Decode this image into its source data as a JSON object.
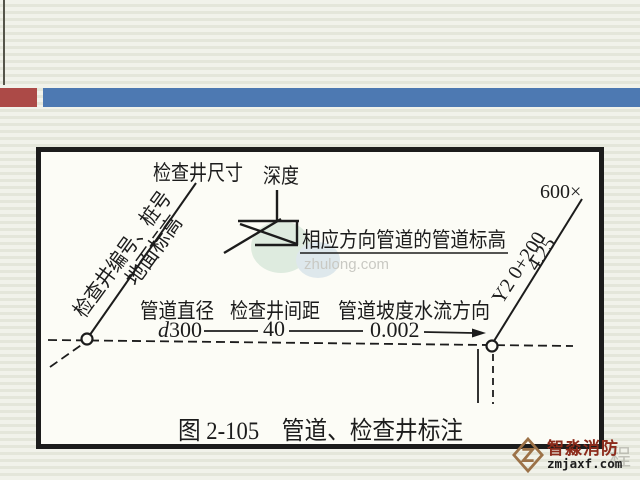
{
  "colors": {
    "accent_red": "#ac4a47",
    "accent_blue": "#4d79b2",
    "slide_bg_light": "#f1f2ea",
    "slide_bg_dark": "#e4e6da",
    "paper": "#fcfcf6",
    "ink": "#1c1c1c",
    "brand_red": "#8c2b1c",
    "logo_tan": "#9c7248",
    "ghost_gray": "#c9c9c3"
  },
  "figure": {
    "top_labels": {
      "well_size": "检查井尺寸",
      "depth": "深度"
    },
    "rotated_left": {
      "well_number": "检查井编号、桩号",
      "ground_elevation": "地面标高"
    },
    "pipe_elevation_label": "相应方向管道的管道标高",
    "column_labels": {
      "pipe_diameter": "管道直径",
      "well_spacing": "检查井间距",
      "slope_flow": "管道坡度水流方向"
    },
    "values": {
      "diameter_prefix": "d",
      "diameter_number": "300",
      "spacing": "40",
      "slope": "0.002"
    },
    "right_leader": {
      "station_end": "600×",
      "well_id_station": "Y2  0+200",
      "invert_elevation": "4.25"
    },
    "caption": "图 2-105　管道、检查井标注",
    "center_watermark": "zhulong.com"
  },
  "site_watermark": {
    "brand": "智淼消防",
    "domain": "zmjaxf.com",
    "ghost_char": "程"
  }
}
